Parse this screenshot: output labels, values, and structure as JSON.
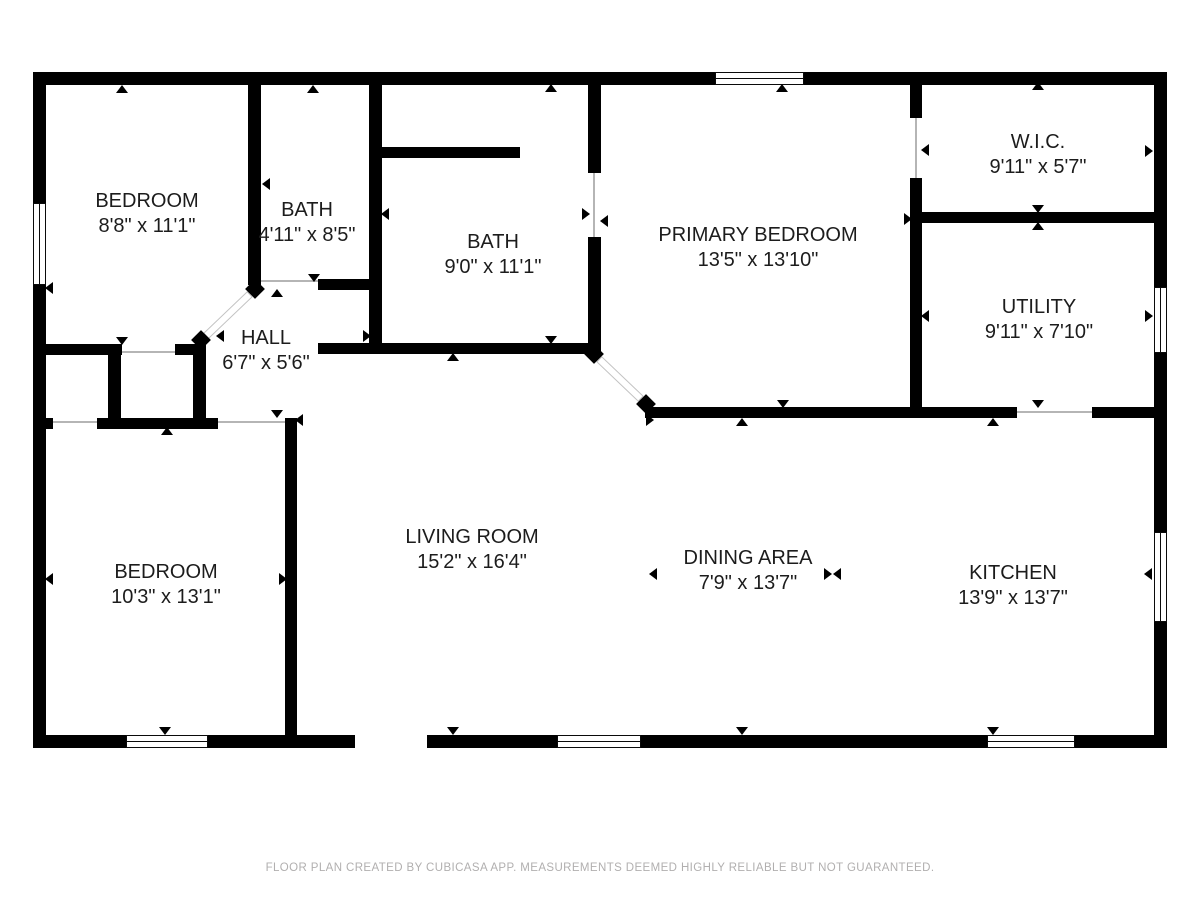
{
  "footer": {
    "text": "FLOOR PLAN CREATED BY CUBICASA APP. MEASUREMENTS DEEMED HIGHLY RELIABLE BUT NOT GUARANTEED.",
    "y": 862
  },
  "colors": {
    "wall": "#000000",
    "label": "#1c1c1c",
    "footer": "#b1afaf",
    "background": "#ffffff"
  },
  "rooms": [
    {
      "id": "bedroom-top-left",
      "name": "BEDROOM",
      "dims": "8'8\" x 11'1\"",
      "cx": 147,
      "cy": 202
    },
    {
      "id": "bath-small",
      "name": "BATH",
      "dims": "4'11\" x 8'5\"",
      "cx": 307,
      "cy": 211
    },
    {
      "id": "bath-large",
      "name": "BATH",
      "dims": "9'0\" x 11'1\"",
      "cx": 493,
      "cy": 243
    },
    {
      "id": "primary-bedroom",
      "name": "PRIMARY BEDROOM",
      "dims": "13'5\" x 13'10\"",
      "cx": 758,
      "cy": 236
    },
    {
      "id": "wic",
      "name": "W.I.C.",
      "dims": "9'11\" x 5'7\"",
      "cx": 1038,
      "cy": 143
    },
    {
      "id": "utility",
      "name": "UTILITY",
      "dims": "9'11\" x 7'10\"",
      "cx": 1039,
      "cy": 308
    },
    {
      "id": "hall",
      "name": "HALL",
      "dims": "6'7\" x 5'6\"",
      "cx": 266,
      "cy": 339
    },
    {
      "id": "bedroom-bottom-left",
      "name": "BEDROOM",
      "dims": "10'3\" x 13'1\"",
      "cx": 166,
      "cy": 573
    },
    {
      "id": "living-room",
      "name": "LIVING ROOM",
      "dims": "15'2\" x 16'4\"",
      "cx": 472,
      "cy": 538
    },
    {
      "id": "dining-area",
      "name": "DINING AREA",
      "dims": "7'9\" x 13'7\"",
      "cx": 748,
      "cy": 559
    },
    {
      "id": "kitchen",
      "name": "KITCHEN",
      "dims": "13'9\" x 13'7\"",
      "cx": 1013,
      "cy": 574
    }
  ],
  "walls": [
    {
      "x": 33,
      "y": 72,
      "w": 1134,
      "h": 13
    },
    {
      "x": 33,
      "y": 735,
      "w": 1134,
      "h": 13
    },
    {
      "x": 33,
      "y": 72,
      "w": 13,
      "h": 676
    },
    {
      "x": 1154,
      "y": 72,
      "w": 13,
      "h": 676
    },
    {
      "x": 248,
      "y": 85,
      "w": 13,
      "h": 200
    },
    {
      "x": 318,
      "y": 279,
      "w": 63,
      "h": 11
    },
    {
      "x": 369,
      "y": 85,
      "w": 13,
      "h": 269
    },
    {
      "x": 382,
      "y": 147,
      "w": 138,
      "h": 11
    },
    {
      "x": 588,
      "y": 85,
      "w": 13,
      "h": 88
    },
    {
      "x": 588,
      "y": 237,
      "w": 13,
      "h": 115
    },
    {
      "x": 318,
      "y": 343,
      "w": 283,
      "h": 11
    },
    {
      "x": 46,
      "y": 344,
      "w": 76,
      "h": 11
    },
    {
      "x": 175,
      "y": 344,
      "w": 31,
      "h": 11
    },
    {
      "x": 108,
      "y": 344,
      "w": 13,
      "h": 84
    },
    {
      "x": 193,
      "y": 344,
      "w": 13,
      "h": 84
    },
    {
      "x": 97,
      "y": 418,
      "w": 121,
      "h": 11
    },
    {
      "x": 46,
      "y": 418,
      "w": 7,
      "h": 11
    },
    {
      "x": 285,
      "y": 418,
      "w": 12,
      "h": 317
    },
    {
      "x": 645,
      "y": 407,
      "w": 372,
      "h": 11
    },
    {
      "x": 1092,
      "y": 407,
      "w": 63,
      "h": 11
    },
    {
      "x": 910,
      "y": 85,
      "w": 12,
      "h": 33
    },
    {
      "x": 910,
      "y": 178,
      "w": 12,
      "h": 240
    },
    {
      "x": 910,
      "y": 212,
      "w": 244,
      "h": 11
    }
  ],
  "windows": [
    {
      "x": 715,
      "y": 72,
      "w": 89,
      "h": 13,
      "o": "h"
    },
    {
      "x": 33,
      "y": 203,
      "w": 13,
      "h": 82,
      "o": "v"
    },
    {
      "x": 1154,
      "y": 287,
      "w": 13,
      "h": 66,
      "o": "v"
    },
    {
      "x": 1154,
      "y": 532,
      "w": 13,
      "h": 90,
      "o": "v"
    },
    {
      "x": 126,
      "y": 735,
      "w": 82,
      "h": 13,
      "o": "h"
    },
    {
      "x": 557,
      "y": 735,
      "w": 84,
      "h": 13,
      "o": "h"
    },
    {
      "x": 987,
      "y": 735,
      "w": 88,
      "h": 13,
      "o": "h"
    }
  ],
  "openings": [
    {
      "x": 355,
      "y": 735,
      "w": 72,
      "h": 13
    }
  ],
  "thresholds": [
    {
      "x": 261,
      "y": 280,
      "w": 57,
      "h": 2
    },
    {
      "x": 122,
      "y": 351,
      "w": 53,
      "h": 2
    },
    {
      "x": 53,
      "y": 421,
      "w": 44,
      "h": 2
    },
    {
      "x": 218,
      "y": 421,
      "w": 67,
      "h": 2
    },
    {
      "x": 1017,
      "y": 411,
      "w": 75,
      "h": 2
    },
    {
      "x": 593,
      "y": 173,
      "w": 2,
      "h": 64
    },
    {
      "x": 915,
      "y": 118,
      "w": 2,
      "h": 60
    }
  ],
  "door_caps": [
    {
      "cx": 255,
      "cy": 289
    },
    {
      "cx": 201,
      "cy": 340
    },
    {
      "cx": 594,
      "cy": 354
    },
    {
      "cx": 646,
      "cy": 404
    }
  ],
  "door_leaves": [
    {
      "x1": 250,
      "y1": 294,
      "x2": 206,
      "y2": 336
    },
    {
      "x1": 599,
      "y1": 359,
      "x2": 641,
      "y2": 399
    }
  ],
  "arrows": [
    {
      "x": 122,
      "y": 89,
      "d": "up"
    },
    {
      "x": 313,
      "y": 89,
      "d": "up"
    },
    {
      "x": 551,
      "y": 88,
      "d": "up"
    },
    {
      "x": 782,
      "y": 88,
      "d": "up"
    },
    {
      "x": 1038,
      "y": 86,
      "d": "up"
    },
    {
      "x": 277,
      "y": 293,
      "d": "up"
    },
    {
      "x": 453,
      "y": 357,
      "d": "up"
    },
    {
      "x": 742,
      "y": 422,
      "d": "up"
    },
    {
      "x": 167,
      "y": 431,
      "d": "up"
    },
    {
      "x": 1038,
      "y": 226,
      "d": "up"
    },
    {
      "x": 993,
      "y": 422,
      "d": "up"
    },
    {
      "x": 122,
      "y": 341,
      "d": "down"
    },
    {
      "x": 314,
      "y": 278,
      "d": "down"
    },
    {
      "x": 551,
      "y": 340,
      "d": "down"
    },
    {
      "x": 783,
      "y": 404,
      "d": "down"
    },
    {
      "x": 1038,
      "y": 209,
      "d": "down"
    },
    {
      "x": 1038,
      "y": 404,
      "d": "down"
    },
    {
      "x": 277,
      "y": 414,
      "d": "down"
    },
    {
      "x": 453,
      "y": 731,
      "d": "down"
    },
    {
      "x": 742,
      "y": 731,
      "d": "down"
    },
    {
      "x": 165,
      "y": 731,
      "d": "down"
    },
    {
      "x": 993,
      "y": 731,
      "d": "down"
    },
    {
      "x": 49,
      "y": 288,
      "d": "left"
    },
    {
      "x": 266,
      "y": 184,
      "d": "left"
    },
    {
      "x": 385,
      "y": 214,
      "d": "left"
    },
    {
      "x": 604,
      "y": 221,
      "d": "left"
    },
    {
      "x": 925,
      "y": 150,
      "d": "left"
    },
    {
      "x": 925,
      "y": 316,
      "d": "left"
    },
    {
      "x": 1148,
      "y": 574,
      "d": "left"
    },
    {
      "x": 653,
      "y": 574,
      "d": "left"
    },
    {
      "x": 837,
      "y": 574,
      "d": "left"
    },
    {
      "x": 299,
      "y": 420,
      "d": "left"
    },
    {
      "x": 220,
      "y": 336,
      "d": "left"
    },
    {
      "x": 49,
      "y": 579,
      "d": "left"
    },
    {
      "x": 367,
      "y": 336,
      "d": "right"
    },
    {
      "x": 586,
      "y": 214,
      "d": "right"
    },
    {
      "x": 1149,
      "y": 151,
      "d": "right"
    },
    {
      "x": 1149,
      "y": 316,
      "d": "right"
    },
    {
      "x": 283,
      "y": 579,
      "d": "right"
    },
    {
      "x": 828,
      "y": 574,
      "d": "right"
    },
    {
      "x": 650,
      "y": 420,
      "d": "right"
    },
    {
      "x": 908,
      "y": 219,
      "d": "right"
    }
  ]
}
